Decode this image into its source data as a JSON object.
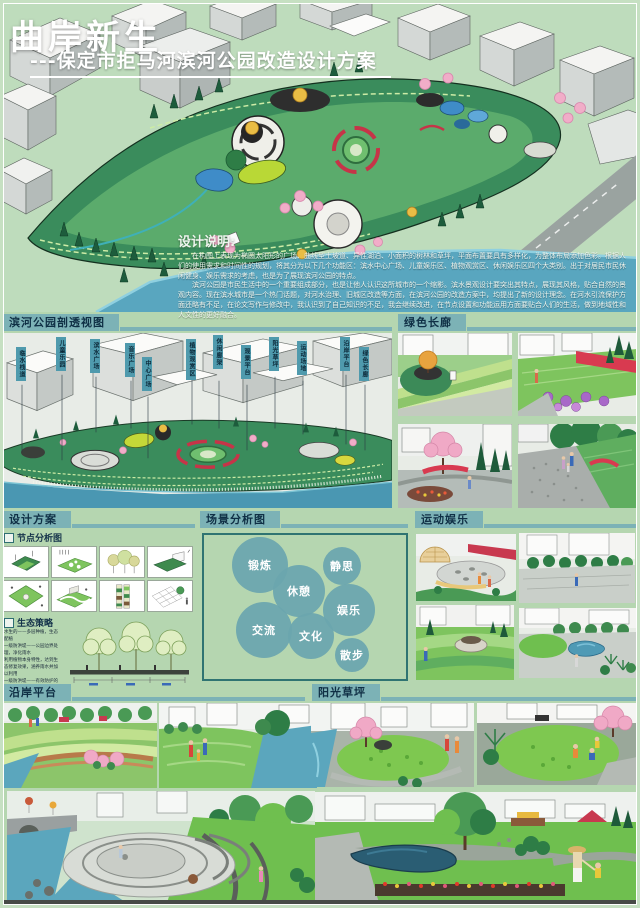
{
  "poster": {
    "title": "曲岸新生",
    "subtitle": "---保定市拒马河滨河公园改造设计方案"
  },
  "design_notes": {
    "heading": "设计说明:",
    "para1": "在构图上表现为椭圆太阳形的广场、曲线型土坡道、异性湖泊、小面积的树林和草坪，平面布置要具有多样化，为整体布局添加色彩。根据人们的使用需求和时间性的规划，将其分为以下几个功能区：滨水中心广场、儿童娱乐区、植物观赏区、休闲娱乐区四个大类别。出于对居民市民休闲健身、娱乐需求的考虑，也是为了展现滨河公园的特点。",
    "para2": "滨河公园是市民生活中的一个重要组成部分，也是让他人认识这所城市的一个缩影。滨水景观设计要突出其特点，展现其风格，贴合自然的景观内容。现在滨水城市是一个热门话题，对河水治理、旧城区改造等方面，在滨河公园的改造方案中，均提出了新的设计理念。在河水引流保护方面还略有不足，在论文写作与修改中，我认识到了自己知识的不足，我会继续改进，在节点设置和功能运用方面要贴合人们的生活，做到地域性和人文性的更好融合。"
  },
  "sections": {
    "perspective": {
      "label": "滨河公园剖透视图",
      "tags": [
        "临水栈道",
        "儿童乐园",
        "滨水广场",
        "音乐广场",
        "中心广场",
        "植物观赏区",
        "休闲廊架",
        "观景平台",
        "阳光草坪",
        "运动场地",
        "沿岸平台",
        "绿色长廊"
      ]
    },
    "green_corridor": {
      "label": "绿色长廊"
    },
    "design_plan": {
      "label": "设计方案",
      "node_analysis": "节点分析图",
      "eco": "生态策略",
      "eco_text": "水生的——多层种植，生态配植\n一级防洪堤——公园边界处理，净化雨水\n利用植物本身特性，达到生态修复效果，涵养雨水并加以利用\n一级防洪堤——有效防护的同时不影响观景，贴合防洪标准，保护公园核心"
    },
    "scene": {
      "label": "场景分析图",
      "bubbles": [
        "锻炼",
        "静思",
        "休憩",
        "娱乐",
        "交流",
        "文化",
        "散步"
      ]
    },
    "sports": {
      "label": "运动娱乐"
    },
    "platform": {
      "label": "沿岸平台"
    },
    "lawn": {
      "label": "阳光草坪"
    }
  },
  "colors": {
    "background": "#b5d6b0",
    "tab": "#7cb2b6",
    "tab_text": "#0f2f45",
    "bubble": "#6aa6ae",
    "water": "#59a6bf",
    "scene_border": "#2f7472"
  }
}
